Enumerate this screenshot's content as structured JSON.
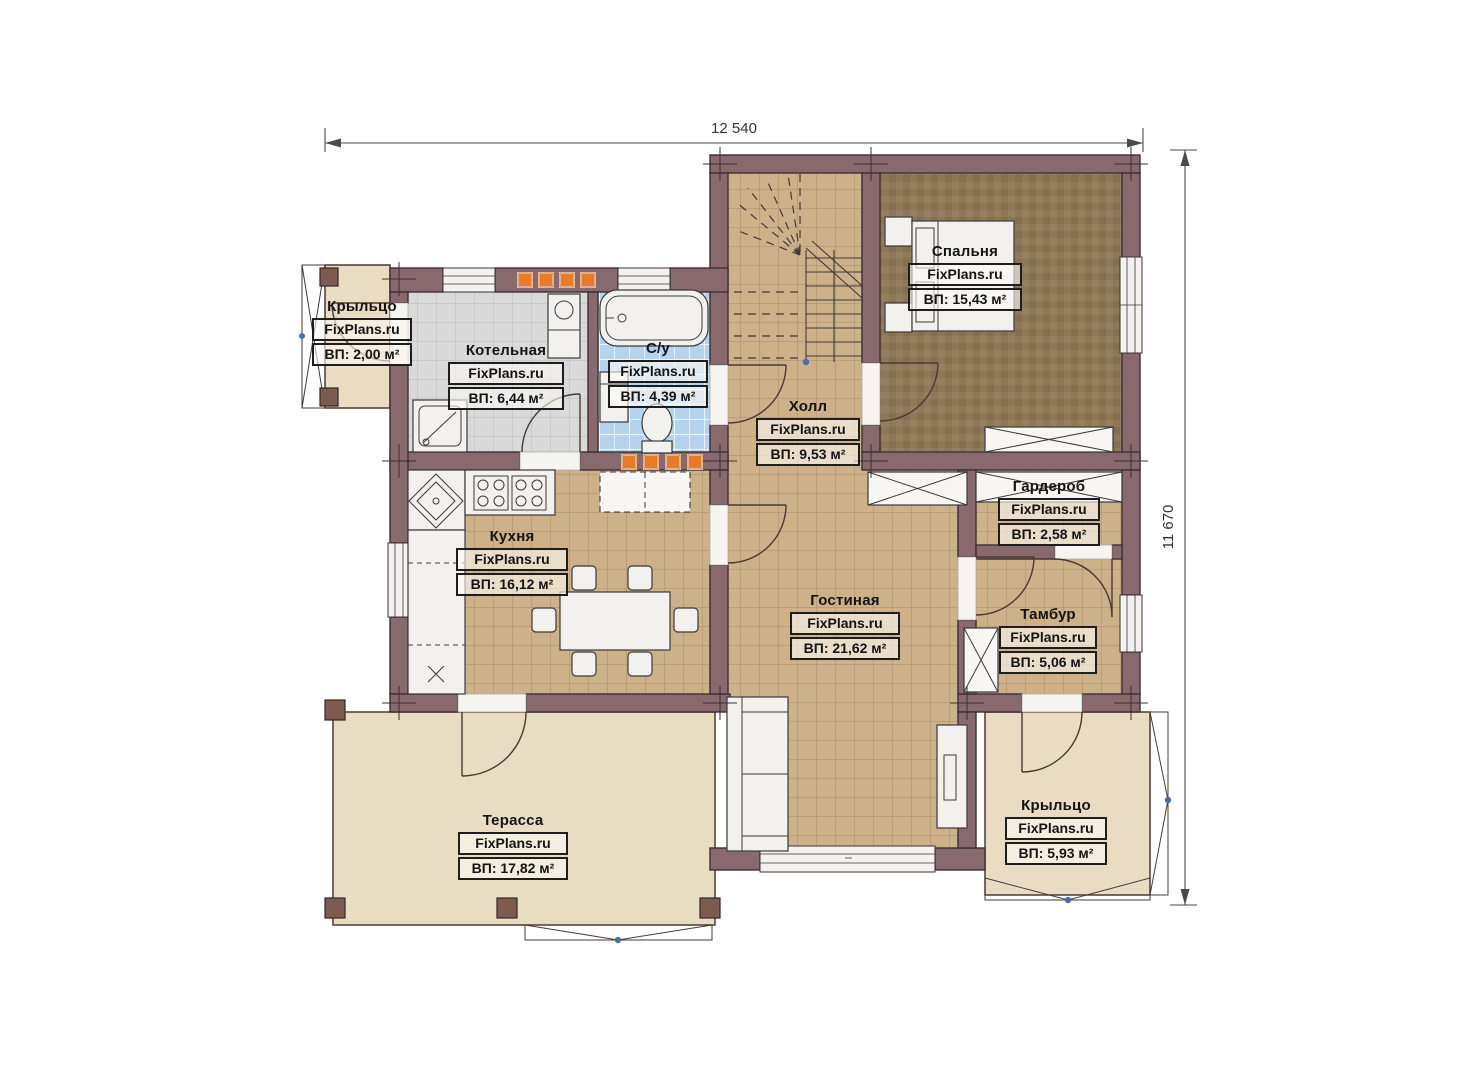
{
  "plan": {
    "type": "floor-plan",
    "branding": "FixPlans.ru"
  },
  "dimensions": {
    "width_label": "12 540",
    "height_label": "11 670"
  },
  "rooms": [
    {
      "id": "porch-left",
      "name": "Крыльцо",
      "watermark": "FixPlans.ru",
      "area": "ВП: 2,00 м²"
    },
    {
      "id": "boiler",
      "name": "Котельная",
      "watermark": "FixPlans.ru",
      "area": "ВП: 6,44 м²"
    },
    {
      "id": "bathroom",
      "name": "С/у",
      "watermark": "FixPlans.ru",
      "area": "ВП: 4,39 м²"
    },
    {
      "id": "hall",
      "name": "Холл",
      "watermark": "FixPlans.ru",
      "area": "ВП: 9,53 м²"
    },
    {
      "id": "bedroom",
      "name": "Спальня",
      "watermark": "FixPlans.ru",
      "area": "ВП: 15,43 м²"
    },
    {
      "id": "kitchen",
      "name": "Кухня",
      "watermark": "FixPlans.ru",
      "area": "ВП: 16,12 м²"
    },
    {
      "id": "living",
      "name": "Гостиная",
      "watermark": "FixPlans.ru",
      "area": "ВП: 21,62 м²"
    },
    {
      "id": "wardrobe",
      "name": "Гардероб",
      "watermark": "FixPlans.ru",
      "area": "ВП: 2,58 м²"
    },
    {
      "id": "tambour",
      "name": "Тамбур",
      "watermark": "FixPlans.ru",
      "area": "ВП: 5,06 м²"
    },
    {
      "id": "terrace",
      "name": "Терасса",
      "watermark": "FixPlans.ru",
      "area": "ВП: 17,82 м²"
    },
    {
      "id": "porch-right",
      "name": "Крыльцо",
      "watermark": "FixPlans.ru",
      "area": "ВП: 5,93 м²"
    }
  ],
  "colors": {
    "wall": "#87696e",
    "wallStroke": "#3b3036",
    "beigeTile": "#cdb189",
    "beigeGrout": "#a58c69",
    "grayTile": "#d9d9d9",
    "grayGrout": "#b9b9b9",
    "blueTile": "#b5d3ec",
    "blueGrout": "#ffffff",
    "bedroomFloor": "#8e7957",
    "terraceFloor": "#e8dcc3",
    "porchFloor": "#e9dcc3",
    "orange": "#e87b28",
    "post": "#7d5b4e",
    "dimLine": "#4a4a4a",
    "pivot": "#4a6fa5",
    "labelBg": "rgba(252,249,242,0.62)"
  }
}
